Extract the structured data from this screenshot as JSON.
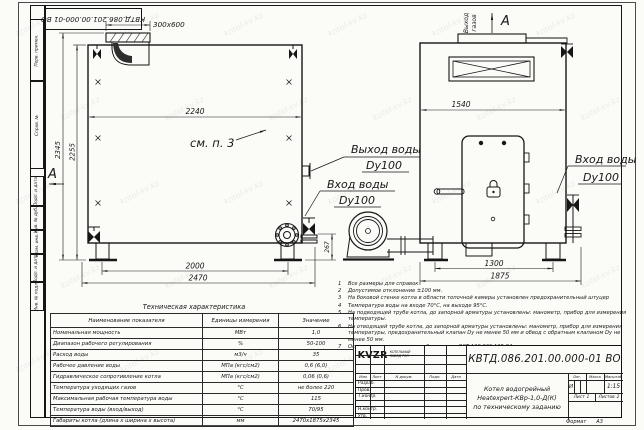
{
  "stamp": {
    "doc_number": "КВТД.086.201.00.000-01 ВО"
  },
  "sidebar": {
    "fields": [
      "Перв. примен.",
      "Справ. №",
      "Подп. и дата",
      "Инв. № дубл.",
      "Взам. инв. №",
      "Подп. и дата",
      "Инв. № подл."
    ]
  },
  "drawing": {
    "dims": {
      "flue_opening": "300x600",
      "side_width": "2240",
      "total_height": "2345",
      "body_height": "2255",
      "legs_span": "2000",
      "total_length": "2470",
      "axis_height": "267",
      "front_width": "1540",
      "front_legs_span": "1300",
      "front_total_width": "1875"
    },
    "labels": {
      "see_item": "см. п. 3",
      "section_mark": "А",
      "gas_out_line1": "Выход",
      "gas_out_line2": "газов",
      "water_out": "Выход воды",
      "water_in": "Вход воды",
      "dn": "Dy100"
    }
  },
  "notes": {
    "items": [
      {
        "n": "1",
        "text": "Все размеры для справок"
      },
      {
        "n": "2",
        "text": "Допустимое отклонение ±100 мм."
      },
      {
        "n": "3",
        "text": "На боковой стенке котла в области топочной камеры установлен предохранительный штуцер"
      },
      {
        "n": "4",
        "text": "Температура воды на входе 70°С, на выходе 95°С."
      },
      {
        "n": "5",
        "text": "На подводящей трубе котла, до запорной арматуры установлены: манометр, прибор для измерения температуры."
      },
      {
        "n": "6",
        "text": "На отводящей трубе котла, до запорной арматуры установлены: манометр, прибор для измерения температуры, предохранительный клапан Dу не менее 50 мм и обвод с обратным клапаном Dу не менее 50 мм."
      },
      {
        "n": "7",
        "text": "Остальные технические требования по ОСТ 108.030.135-84."
      }
    ]
  },
  "spec_table": {
    "title": "Техническая характеристика",
    "headers": [
      "Наименование показателя",
      "Единицы измерения",
      "Значение"
    ],
    "rows": [
      {
        "name": "Номинальная мощность",
        "unit": "МВт",
        "value": "1,0"
      },
      {
        "name": "Диапазон рабочего регулирования",
        "unit": "%",
        "value": "50-100"
      },
      {
        "name": "Расход воды",
        "unit": "м3/ч",
        "value": "35"
      },
      {
        "name": "Рабочее давление воды",
        "unit": "МПа (кгс/см2)",
        "value": "0,6 (6,0)"
      },
      {
        "name": "Гидравлическое сопротивление котла",
        "unit": "МПа (кгс/см2)",
        "value": "0,06 (0,6)"
      },
      {
        "name": "Температура уходящих газов",
        "unit": "°С",
        "value": "не более 220"
      },
      {
        "name": "Максимальная рабочая температура воды",
        "unit": "°С",
        "value": "115"
      },
      {
        "name": "Температура воды (вход/выход)",
        "unit": "°С",
        "value": "70/95"
      },
      {
        "name": "Габариты котла (длина х ширина х высота)",
        "unit": "мм",
        "value": "2470х1875х2345"
      }
    ]
  },
  "title_block": {
    "doc_number": "КВТД.086.201.00.000-01 ВО",
    "name_line1": "Котел водогрейный",
    "name_line2": "Heatexpert-КВр-1,0-Д(К)",
    "name_line3": "по техническому заданию",
    "col_izm": "Изм",
    "col_list": "Лист",
    "col_ndoc": "N докум.",
    "col_podp": "Подп.",
    "col_data": "Дата",
    "row_razrab": "Разраб.",
    "row_prov": "Пров.",
    "row_tkontr": "Т.контр.",
    "row_nkontr": "Н.контр.",
    "row_utv": "Утв.",
    "lit_label": "Лит.",
    "mass_label": "Масса",
    "scale_label": "Масштаб",
    "lit_value": "И",
    "scale_value": "1:15",
    "sheet_label": "Лист",
    "sheet_value": "1",
    "sheets_label": "Листов",
    "sheets_value": "2",
    "logo_text": "KVZR",
    "company_line1": "КОТЕЛЬНЫЙ",
    "company_line2": "ЗАВОД РЭП",
    "format_label": "Формат",
    "format_value": "А3"
  },
  "watermark": {
    "text": "kotel-kv.kz"
  },
  "colors": {
    "line": "#161616",
    "paper": "#fbfbf8"
  }
}
